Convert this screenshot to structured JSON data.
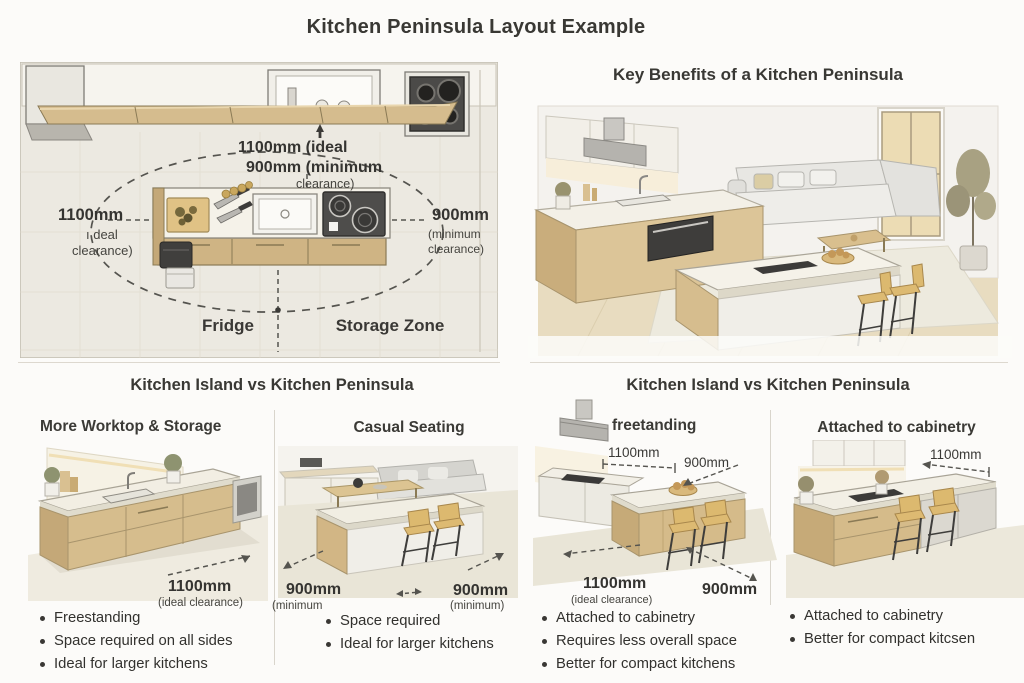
{
  "title": "Kitchen Peninsula Layout Example",
  "floorplan": {
    "top_line1": "1100mm (ideal",
    "top_line2": "900mm (minimum",
    "top_line3": "clearance)",
    "left_value": "1100mm",
    "left_line2": "ı deal",
    "left_line3": "clearance)",
    "right_value": "900mm",
    "right_line2": "(minimum",
    "right_line3": "clearance)",
    "zone_left": "Fridge",
    "zone_right": "Storage Zone"
  },
  "benefits": {
    "title": "Key Benefits of a Kitchen Peninsula"
  },
  "compare_left": {
    "title": "Kitchen Island vs Kitchen Peninsula",
    "col1": {
      "heading": "More Worktop & Storage",
      "measure": "1100mm",
      "measure_sub": "(ideal clearance)",
      "bullets": [
        "Freestanding",
        "Space required on all sides",
        "Ideal for larger kitchens"
      ]
    },
    "col2": {
      "heading": "Casual Seating",
      "left_measure": "900mm",
      "left_measure_sub": "(minimum",
      "right_measure": "900mm",
      "right_measure_sub": "(minimum)",
      "bullets": [
        "Space required",
        "Ideal for larger kitchens"
      ]
    }
  },
  "compare_right": {
    "title": "Kitchen Island vs Kitchen Peninsula",
    "col1": {
      "heading": "freetanding",
      "top_measure1": "1100mm",
      "top_measure2": "900mm",
      "bottom_measure1": "1100mm",
      "bottom_measure1_sub": "(ideal clearance)",
      "bottom_measure2": "900mm",
      "bullets": [
        "Attached to cabinetry",
        "Requires less overall space",
        "Better for compact kitchens"
      ]
    },
    "col2": {
      "heading": "Attached to cabinetry",
      "measure": "1100mm",
      "bullets": [
        "Attached to cabinetry",
        "Better for compact kitcsen"
      ]
    }
  },
  "colors": {
    "background": "#fcfbf9",
    "panel_floor": "#ece9e1",
    "wood": "#d5bc8e",
    "counter_white": "#f4f1e8",
    "appliance_dark": "#4c4b49",
    "text": "#3a3835",
    "dashed_line": "#55544f"
  }
}
